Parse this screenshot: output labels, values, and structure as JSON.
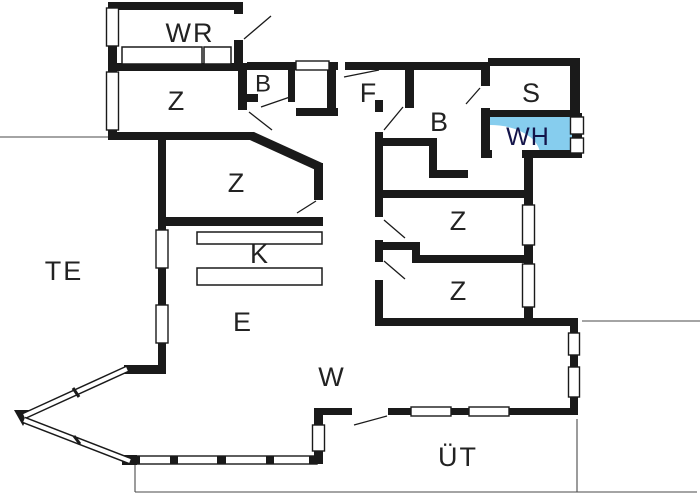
{
  "plan": {
    "type": "floor-plan",
    "background_color": "#ffffff",
    "wall_color": "#1a1a1a",
    "highlight_color": "#86cdee",
    "highlighted_room": "WH",
    "rooms": [
      {
        "id": "wr",
        "label": "WR"
      },
      {
        "id": "z-top-left",
        "label": "Z"
      },
      {
        "id": "b-small",
        "label": "B"
      },
      {
        "id": "f",
        "label": "F"
      },
      {
        "id": "b-bath",
        "label": "B"
      },
      {
        "id": "s",
        "label": "S"
      },
      {
        "id": "wh",
        "label": "WH"
      },
      {
        "id": "z-mid-left",
        "label": "Z"
      },
      {
        "id": "k",
        "label": "K"
      },
      {
        "id": "te",
        "label": "TE"
      },
      {
        "id": "z-right-1",
        "label": "Z"
      },
      {
        "id": "z-right-2",
        "label": "Z"
      },
      {
        "id": "e",
        "label": "E"
      },
      {
        "id": "w",
        "label": "W"
      },
      {
        "id": "ut",
        "label": "ÜT"
      }
    ]
  }
}
